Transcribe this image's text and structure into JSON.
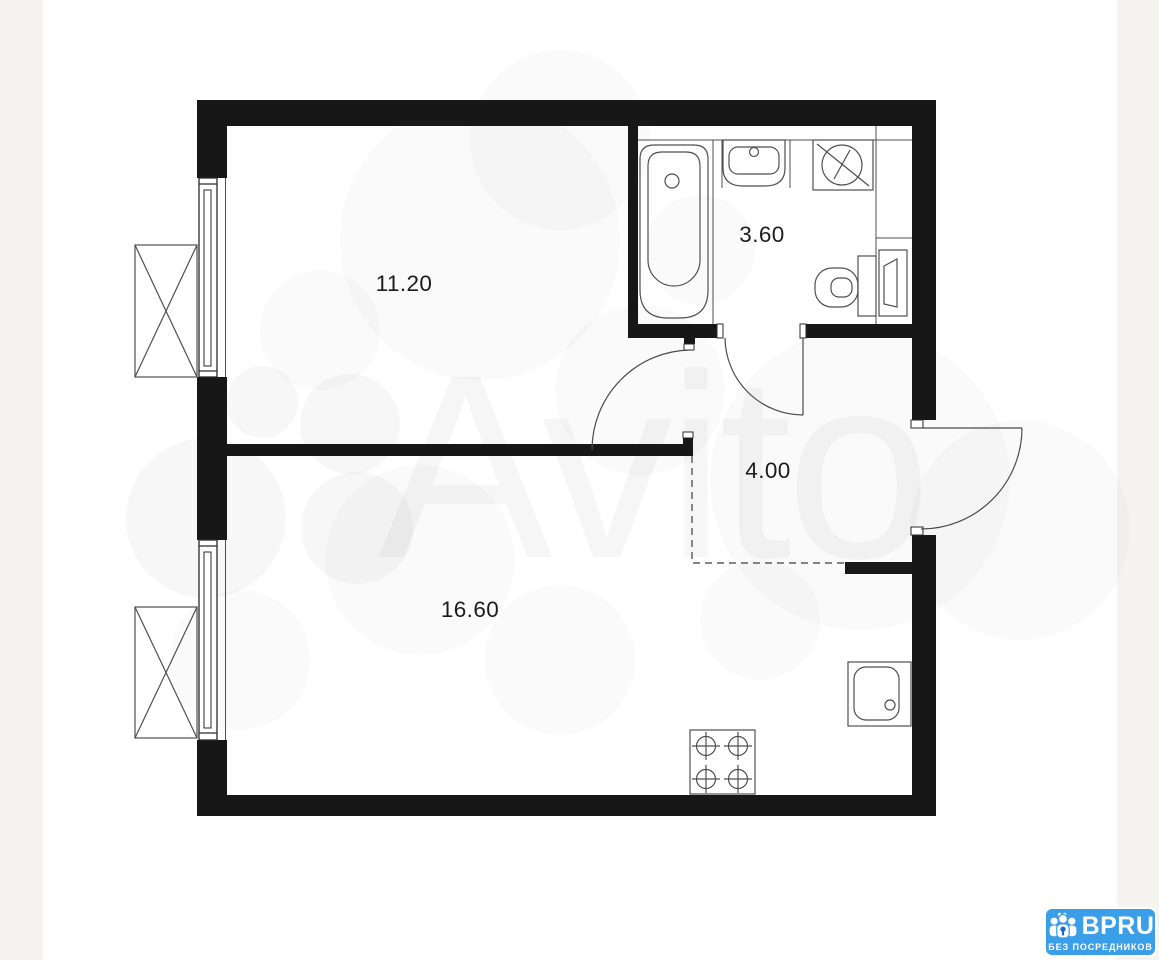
{
  "page": {
    "background": "#ffffff",
    "margin_band_color": "#f5f4f1"
  },
  "floor_plan": {
    "wall_color": "#171717",
    "fixture_line_color": "#4f4f4f",
    "rooms": [
      {
        "name": "room-11-20",
        "area_label": "11.20"
      },
      {
        "name": "bathroom",
        "area_label": "3.60"
      },
      {
        "name": "hallway",
        "area_label": "4.00"
      },
      {
        "name": "room-16-60",
        "area_label": "16.60"
      }
    ]
  },
  "watermark": {
    "text": "Avito"
  },
  "badge": {
    "brand": "BPRU",
    "subtitle": "БЕЗ ПОСРЕДНИКОВ",
    "background_color": "#3B9EE9"
  }
}
